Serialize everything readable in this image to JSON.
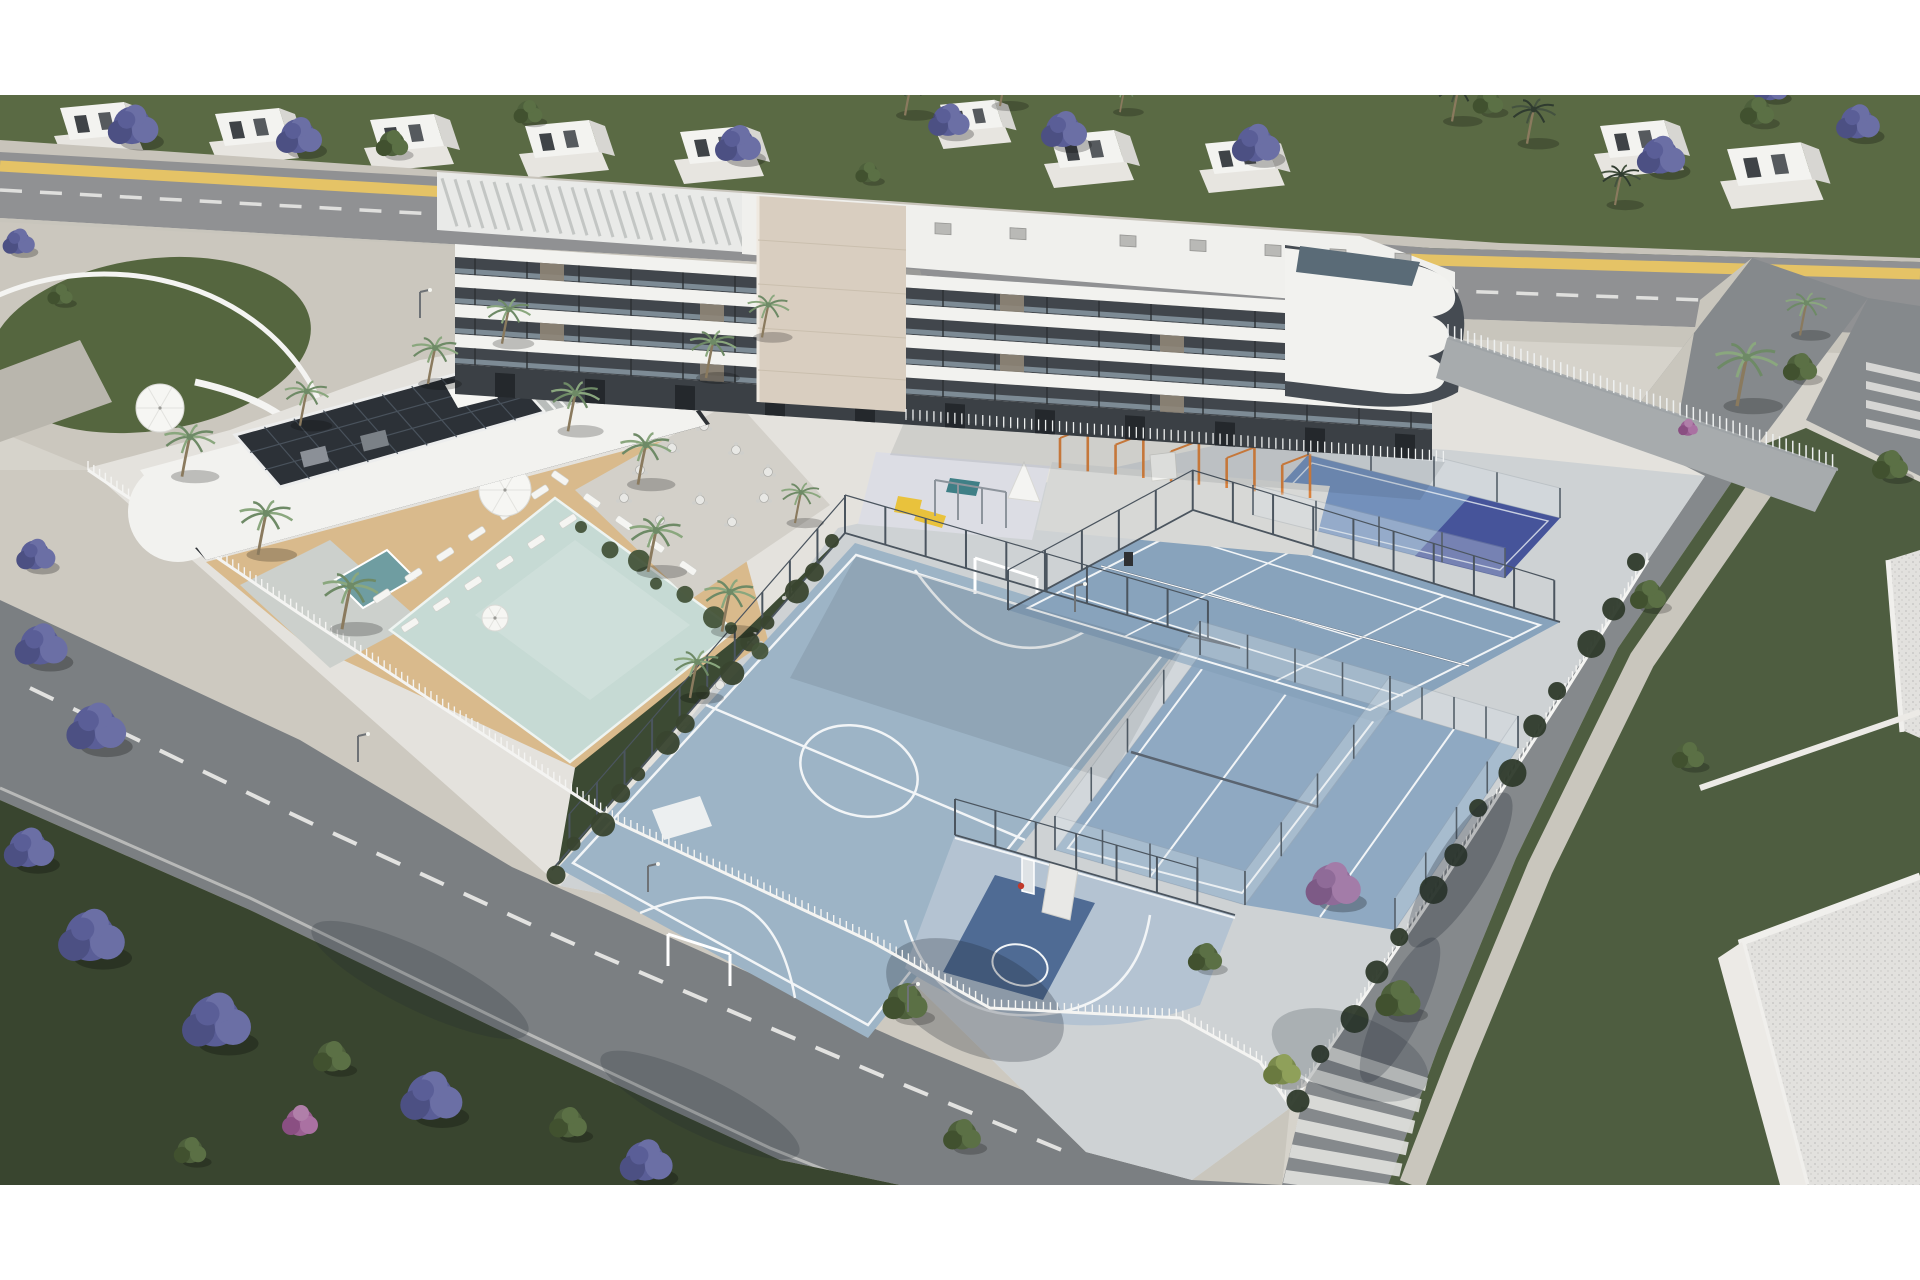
{
  "meta": {
    "title": "Aerial architectural rendering of a white residential complex with pool deck, futsal court, basketball half-court, padel and tennis courts, tree-lined streets",
    "type": "3d-render",
    "visible_text": []
  },
  "palette": {
    "paper": "#ffffff",
    "ground_base": "#d6d3cb",
    "plaza": "#cbc7be",
    "sidewalk": "#cac6bd",
    "road_top": "#909193",
    "road_bottom": "#7b7f82",
    "road_right": "#85898c",
    "road_line_yellow": "#e5c366",
    "road_line_white": "#e8e8e6",
    "grass_top": "#5a6a44",
    "grass_dark": "#39452f",
    "lawn_right": "#4e5d40",
    "compound": "#e4e2dd",
    "courts_base": "#ced2d4",
    "futsal": "#9db4c6",
    "basketball": "#b4c3d2",
    "basketball_key": "#4f6b94",
    "padel": "#8fa9c2",
    "tennis": "#88a3bc",
    "navy_court": "#46549a",
    "court_line": "#f2f5f7",
    "pool": "#c6dad4",
    "jacuzzi": "#6f9da1",
    "sand": "#d9ba8c",
    "pebble": "#ccd0cc",
    "building_white": "#f2f2ef",
    "building_dark": "#41464c",
    "building_glass": "#92a3ad",
    "stone_tower": "#d9cec0",
    "roof_white": "#f0f0ed",
    "solar": "#2c3137",
    "fence_white": "#f4f4f2",
    "fence_dark": "#4b555f",
    "hedge": "#2e3a2b",
    "jacaranda": "#5a5e97",
    "jacaranda_light": "#6b6fa5",
    "pink_bush": "#9a5f92",
    "tree_green": "#4e603c",
    "palm": "#6e8a66",
    "playground_paving": "#dcdde4",
    "slide_yellow": "#e9c23c",
    "calisthenics_orange": "#d9813c"
  },
  "scene": {
    "houses": [
      {
        "x": 60,
        "y": 100,
        "s": 1
      },
      {
        "x": 215,
        "y": 106,
        "s": 1
      },
      {
        "x": 370,
        "y": 112,
        "s": 1
      },
      {
        "x": 525,
        "y": 118,
        "s": 1
      },
      {
        "x": 680,
        "y": 124,
        "s": 1
      },
      {
        "x": 940,
        "y": 98,
        "s": 0.85
      },
      {
        "x": 1050,
        "y": 128,
        "s": 1
      },
      {
        "x": 1205,
        "y": 136,
        "s": 0.95
      },
      {
        "x": 1600,
        "y": 118,
        "s": 1
      },
      {
        "x": 1727,
        "y": 140,
        "s": 1.15
      }
    ],
    "back_trees": [
      {
        "t": "j",
        "x": 132,
        "y": 132,
        "s": 1.1
      },
      {
        "t": "j",
        "x": 298,
        "y": 142,
        "s": 1.0
      },
      {
        "t": "j",
        "x": 737,
        "y": 150,
        "s": 1.0
      },
      {
        "t": "j",
        "x": 948,
        "y": 126,
        "s": 0.9
      },
      {
        "t": "j",
        "x": 1063,
        "y": 136,
        "s": 1.0
      },
      {
        "t": "j",
        "x": 1255,
        "y": 150,
        "s": 1.05
      },
      {
        "t": "j",
        "x": 1660,
        "y": 162,
        "s": 1.05
      },
      {
        "t": "j",
        "x": 1857,
        "y": 128,
        "s": 0.95
      },
      {
        "t": "j",
        "x": 1770,
        "y": 92,
        "s": 0.75
      },
      {
        "t": "j",
        "x": 18,
        "y": 246,
        "s": 0.7
      },
      {
        "t": "g",
        "x": 392,
        "y": 148,
        "s": 0.9
      },
      {
        "t": "g",
        "x": 528,
        "y": 116,
        "s": 0.8
      },
      {
        "t": "g",
        "x": 868,
        "y": 176,
        "s": 0.7
      },
      {
        "t": "g",
        "x": 1488,
        "y": 106,
        "s": 0.85
      },
      {
        "t": "g",
        "x": 1757,
        "y": 116,
        "s": 0.95
      },
      {
        "t": "g",
        "x": 60,
        "y": 298,
        "s": 0.7
      },
      {
        "t": "dp",
        "x": 905,
        "y": 110,
        "s": 0.9
      },
      {
        "t": "dp",
        "x": 1000,
        "y": 101,
        "s": 0.85
      },
      {
        "t": "dp",
        "x": 1452,
        "y": 116,
        "s": 0.9
      },
      {
        "t": "dp",
        "x": 1527,
        "y": 138,
        "s": 0.95
      },
      {
        "t": "dp",
        "x": 1615,
        "y": 200,
        "s": 0.85
      },
      {
        "t": "p",
        "x": 1120,
        "y": 108,
        "s": 0.7
      }
    ],
    "front_trees": [
      {
        "t": "p",
        "x": 182,
        "y": 470,
        "s": 1.1
      },
      {
        "t": "p",
        "x": 258,
        "y": 548,
        "s": 1.15
      },
      {
        "t": "p",
        "x": 342,
        "y": 622,
        "s": 1.2
      },
      {
        "t": "p",
        "x": 300,
        "y": 420,
        "s": 0.95
      },
      {
        "t": "p",
        "x": 428,
        "y": 378,
        "s": 1.0
      },
      {
        "t": "p",
        "x": 502,
        "y": 338,
        "s": 0.95
      },
      {
        "t": "p",
        "x": 568,
        "y": 425,
        "s": 1.05
      },
      {
        "t": "p",
        "x": 638,
        "y": 478,
        "s": 1.1
      },
      {
        "t": "p",
        "x": 706,
        "y": 372,
        "s": 1.0
      },
      {
        "t": "p",
        "x": 762,
        "y": 332,
        "s": 0.9
      },
      {
        "t": "p",
        "x": 648,
        "y": 565,
        "s": 1.15
      },
      {
        "t": "p",
        "x": 722,
        "y": 625,
        "s": 1.1
      },
      {
        "t": "p",
        "x": 690,
        "y": 692,
        "s": 1.0
      },
      {
        "t": "p",
        "x": 795,
        "y": 518,
        "s": 0.85
      },
      {
        "t": "p",
        "x": 1737,
        "y": 398,
        "s": 1.35
      },
      {
        "t": "p",
        "x": 1800,
        "y": 330,
        "s": 0.9
      },
      {
        "t": "g",
        "x": 332,
        "y": 1062,
        "s": 1.05
      },
      {
        "t": "g",
        "x": 568,
        "y": 1128,
        "s": 1.05
      },
      {
        "t": "g",
        "x": 905,
        "y": 1008,
        "s": 1.25
      },
      {
        "t": "g",
        "x": 962,
        "y": 1140,
        "s": 1.05
      },
      {
        "t": "g",
        "x": 1398,
        "y": 1005,
        "s": 1.25
      },
      {
        "t": "g",
        "x": 1205,
        "y": 962,
        "s": 0.95
      },
      {
        "t": "g",
        "x": 1800,
        "y": 372,
        "s": 0.95
      },
      {
        "t": "g",
        "x": 1890,
        "y": 470,
        "s": 1.0
      },
      {
        "t": "g",
        "x": 1648,
        "y": 600,
        "s": 1.0
      },
      {
        "t": "g",
        "x": 1688,
        "y": 760,
        "s": 0.9
      },
      {
        "t": "g",
        "x": 190,
        "y": 1155,
        "s": 0.9
      },
      {
        "t": "yg",
        "x": 1282,
        "y": 1075,
        "s": 1.05
      },
      {
        "t": "j",
        "x": 40,
        "y": 652,
        "s": 1.15
      },
      {
        "t": "j",
        "x": 95,
        "y": 735,
        "s": 1.3
      },
      {
        "t": "j",
        "x": 28,
        "y": 855,
        "s": 1.1
      },
      {
        "t": "j",
        "x": 90,
        "y": 945,
        "s": 1.45
      },
      {
        "t": "j",
        "x": 215,
        "y": 1030,
        "s": 1.5
      },
      {
        "t": "j",
        "x": 430,
        "y": 1105,
        "s": 1.35
      },
      {
        "t": "j",
        "x": 645,
        "y": 1168,
        "s": 1.15
      },
      {
        "t": "j",
        "x": 35,
        "y": 560,
        "s": 0.85
      },
      {
        "t": "jp",
        "x": 1332,
        "y": 892,
        "s": 1.2
      },
      {
        "t": "pk",
        "x": 300,
        "y": 1122,
        "s": 1.0
      },
      {
        "t": "pk",
        "x": 1688,
        "y": 428,
        "s": 0.55
      }
    ],
    "lounger_rows": [
      {
        "a": [
          382,
          596
        ],
        "b": [
          540,
          492
        ],
        "n": 6,
        "rot": -33
      },
      {
        "a": [
          410,
          625
        ],
        "b": [
          568,
          521
        ],
        "n": 6,
        "rot": -33
      },
      {
        "a": [
          560,
          478
        ],
        "b": [
          688,
          568
        ],
        "n": 5,
        "rot": 35
      },
      {
        "a": [
          250,
          462
        ],
        "b": [
          430,
          416
        ],
        "n": 5,
        "rot": -20
      }
    ],
    "tables_garden": [
      [
        790,
        595
      ],
      [
        755,
        640
      ],
      [
        720,
        685
      ],
      [
        685,
        730
      ],
      [
        650,
        775
      ],
      [
        805,
        630
      ],
      [
        770,
        675
      ],
      [
        735,
        720
      ],
      [
        700,
        765
      ],
      [
        670,
        800
      ]
    ],
    "tables_terrace": [
      [
        640,
        470
      ],
      [
        672,
        448
      ],
      [
        704,
        426
      ],
      [
        736,
        450
      ],
      [
        768,
        472
      ],
      [
        700,
        500
      ],
      [
        732,
        522
      ],
      [
        764,
        498
      ],
      [
        660,
        520
      ],
      [
        624,
        498
      ]
    ],
    "umbrellas": [
      [
        160,
        408,
        24
      ],
      [
        505,
        490,
        26
      ],
      [
        495,
        618,
        13
      ]
    ],
    "calisthenics": {
      "x0": 1060,
      "x1": 1310,
      "y0": 442,
      "y1": 472,
      "posts": 10
    },
    "ac_units_x": [
      800,
      860,
      935,
      1010,
      1120,
      1190,
      1265,
      1330,
      1395
    ],
    "stone_pillars_x": [
      540,
      700,
      1000,
      1160,
      1340
    ]
  }
}
